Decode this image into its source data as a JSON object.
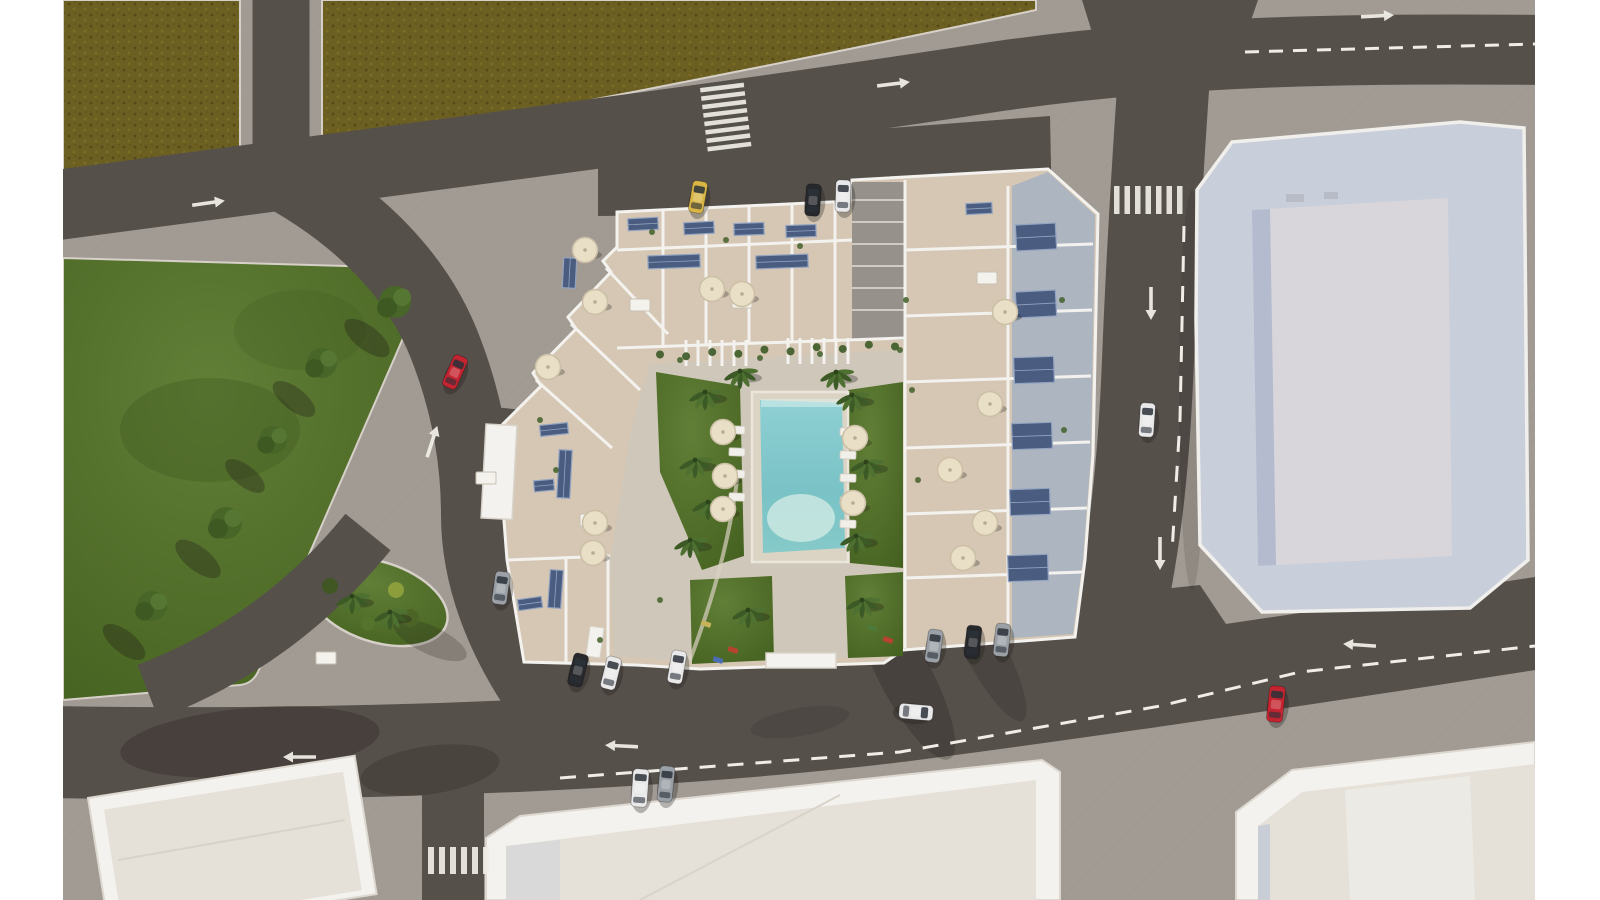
{
  "scene": {
    "title": "Aerial 3D architectural render of a residential apartment complex with rooftop terraces, solar panels and a central courtyard pool",
    "view": "top-down aerial render",
    "environment": "urban block with avenues, crosswalks, lane arrows, parked and moving cars, green park and olive fields"
  },
  "colors": {
    "canvas_bg": "#ffffff",
    "sidewalk": "#a29b94",
    "road": "#56504b",
    "field": "#6c5f22",
    "field_dark": "#554a18",
    "grass": "#587932",
    "grass_dark": "#3e5a20",
    "building_band": "#c9cedb",
    "building_roof": "#d8d6da",
    "building_shade": "#b4bbcf",
    "roof_cream": "#e5e0d8",
    "wall_white": "#f4f2ee",
    "terrace_floor": "#d5c7b4",
    "terrace_floor_blue": "#a9b2c1",
    "courtyard_paving": "#cfc8ba",
    "alley": "#96918b",
    "pool_deep": "#79c2c6",
    "pool_light": "#93d1d4",
    "pool_shallow": "#c6e6e0",
    "solar_panel": "#4a5d80",
    "solar_frame": "#93a3c0",
    "umbrella": "#e9dec6",
    "marking": "#efede6",
    "shadow": "#1f1a16",
    "car_red": "#c42430",
    "car_white": "#e9e9ea",
    "car_black": "#26282c",
    "car_gray": "#9aa0a6",
    "car_yellow": "#d8b545"
  },
  "inventory": {
    "cars": [
      {
        "name": "red-car-park-road",
        "color": "car_red",
        "x": 455,
        "y": 372,
        "rot": 24,
        "l": 34,
        "w": 15
      },
      {
        "name": "white-car-right-road",
        "color": "car_white",
        "x": 1147,
        "y": 420,
        "rot": 4,
        "l": 34,
        "w": 15
      },
      {
        "name": "red-car-bottom-road",
        "color": "car_red",
        "x": 1276,
        "y": 704,
        "rot": 6,
        "l": 36,
        "w": 16
      },
      {
        "name": "white-car-bottom-road",
        "color": "car_white",
        "x": 916,
        "y": 712,
        "rot": 95,
        "l": 34,
        "w": 15
      },
      {
        "name": "white-car-queue-1",
        "color": "car_white",
        "x": 640,
        "y": 788,
        "rot": 4,
        "l": 38,
        "w": 16
      },
      {
        "name": "gray-car-queue-2",
        "color": "car_gray",
        "x": 666,
        "y": 784,
        "rot": 6,
        "l": 36,
        "w": 15
      },
      {
        "name": "yellow-car-top-parking",
        "color": "car_yellow",
        "x": 698,
        "y": 197,
        "rot": 10,
        "l": 32,
        "w": 15
      },
      {
        "name": "black-car-top-parking",
        "color": "car_black",
        "x": 813,
        "y": 200,
        "rot": 4,
        "l": 32,
        "w": 15
      },
      {
        "name": "white-car-top-parking",
        "color": "car_white",
        "x": 843,
        "y": 196,
        "rot": 2,
        "l": 32,
        "w": 15
      },
      {
        "name": "gray-car-left-parking",
        "color": "car_gray",
        "x": 501,
        "y": 588,
        "rot": 8,
        "l": 33,
        "w": 15
      },
      {
        "name": "black-car-bottom-parking-1",
        "color": "car_black",
        "x": 578,
        "y": 670,
        "rot": 14,
        "l": 33,
        "w": 15
      },
      {
        "name": "white-car-bottom-parking-2",
        "color": "car_white",
        "x": 611,
        "y": 673,
        "rot": 14,
        "l": 33,
        "w": 15
      },
      {
        "name": "white-car-bottom-parking-3",
        "color": "car_white",
        "x": 677,
        "y": 667,
        "rot": 10,
        "l": 33,
        "w": 15
      },
      {
        "name": "gray-car-bottom-parking-4",
        "color": "car_gray",
        "x": 934,
        "y": 646,
        "rot": 8,
        "l": 33,
        "w": 15
      },
      {
        "name": "black-car-bottom-parking-5",
        "color": "car_black",
        "x": 973,
        "y": 642,
        "rot": 6,
        "l": 33,
        "w": 15
      },
      {
        "name": "gray-car-bottom-parking-6",
        "color": "car_gray",
        "x": 1002,
        "y": 640,
        "rot": 6,
        "l": 33,
        "w": 15
      }
    ],
    "arrows": [
      {
        "name": "arrow-top-avenue-west",
        "x": 208,
        "y": 203,
        "rot": -8
      },
      {
        "name": "arrow-top-avenue-mid",
        "x": 893,
        "y": 84,
        "rot": -7
      },
      {
        "name": "arrow-top-avenue-east",
        "x": 1377,
        "y": 16,
        "rot": -3
      },
      {
        "name": "arrow-right-road-upper",
        "x": 1151,
        "y": 303,
        "rot": 90
      },
      {
        "name": "arrow-right-road-lower",
        "x": 1160,
        "y": 553,
        "rot": 90
      },
      {
        "name": "arrow-park-road",
        "x": 432,
        "y": 442,
        "rot": -72
      },
      {
        "name": "arrow-bottom-avenue-mid",
        "x": 622,
        "y": 746,
        "rot": 183
      },
      {
        "name": "arrow-bottom-avenue-east",
        "x": 1360,
        "y": 645,
        "rot": 184
      },
      {
        "name": "arrow-bottom-avenue-west",
        "x": 300,
        "y": 757,
        "rot": 180
      }
    ],
    "crosswalks": [
      {
        "name": "crosswalk-top-avenue",
        "x": 700,
        "y": 88,
        "rot": -7,
        "count": 8,
        "stripe_len": 44,
        "stripe_w": 4.5,
        "step": 8.5,
        "orient": "stack"
      },
      {
        "name": "crosswalk-right-road",
        "x": 1114,
        "y": 186,
        "rot": 0,
        "count": 7,
        "stripe_len": 28,
        "stripe_w": 5.5,
        "step": 10.5,
        "orient": "row"
      },
      {
        "name": "crosswalk-side-street",
        "x": 428,
        "y": 847,
        "rot": 0,
        "count": 6,
        "stripe_len": 27,
        "stripe_w": 6,
        "step": 11,
        "orient": "row"
      }
    ],
    "umbrellas": [
      [
        585,
        250
      ],
      [
        712,
        289
      ],
      [
        742,
        294
      ],
      [
        595,
        302
      ],
      [
        548,
        367
      ],
      [
        595,
        523
      ],
      [
        593,
        553
      ],
      [
        723,
        432
      ],
      [
        725,
        476
      ],
      [
        723,
        509
      ],
      [
        855,
        438
      ],
      [
        853,
        503
      ],
      [
        1005,
        312
      ],
      [
        990,
        404
      ],
      [
        950,
        470
      ],
      [
        985,
        523
      ],
      [
        963,
        558
      ]
    ],
    "palm_trees": [
      [
        705,
        392
      ],
      [
        695,
        460
      ],
      [
        708,
        502
      ],
      [
        690,
        540
      ],
      [
        852,
        395
      ],
      [
        866,
        462
      ],
      [
        856,
        536
      ],
      [
        740,
        371
      ],
      [
        836,
        372
      ],
      [
        862,
        600
      ],
      [
        748,
        610
      ],
      [
        352,
        596
      ],
      [
        390,
        612
      ]
    ],
    "park_trees": [
      [
        395,
        302,
        16
      ],
      [
        322,
        363,
        15
      ],
      [
        273,
        440,
        14
      ],
      [
        226,
        523,
        16
      ],
      [
        152,
        606,
        15
      ]
    ],
    "bushes": [
      {
        "x": 410,
        "y": 618,
        "r": 9,
        "c": "#4c6426"
      },
      {
        "x": 330,
        "y": 586,
        "r": 8,
        "c": "#3f5621"
      },
      {
        "x": 368,
        "y": 624,
        "r": 7,
        "c": "#55742c"
      },
      {
        "x": 396,
        "y": 590,
        "r": 8,
        "c": "#8fa03c"
      }
    ],
    "solar_panels": [
      {
        "x": 628,
        "y": 218,
        "w": 30,
        "h": 12,
        "rot": -3
      },
      {
        "x": 684,
        "y": 222,
        "w": 30,
        "h": 12,
        "rot": -3
      },
      {
        "x": 734,
        "y": 223,
        "w": 30,
        "h": 12,
        "rot": -2
      },
      {
        "x": 786,
        "y": 225,
        "w": 30,
        "h": 12,
        "rot": -2
      },
      {
        "x": 648,
        "y": 255,
        "w": 52,
        "h": 13,
        "rot": -2
      },
      {
        "x": 756,
        "y": 255,
        "w": 52,
        "h": 13,
        "rot": -2
      },
      {
        "x": 563,
        "y": 258,
        "w": 13,
        "h": 30,
        "rot": 3
      },
      {
        "x": 540,
        "y": 424,
        "w": 28,
        "h": 11,
        "rot": -6
      },
      {
        "x": 558,
        "y": 450,
        "w": 13,
        "h": 48,
        "rot": 3
      },
      {
        "x": 534,
        "y": 480,
        "w": 20,
        "h": 11,
        "rot": -5
      },
      {
        "x": 549,
        "y": 570,
        "w": 13,
        "h": 38,
        "rot": 4
      },
      {
        "x": 518,
        "y": 598,
        "w": 24,
        "h": 11,
        "rot": -8
      },
      {
        "x": 1016,
        "y": 224,
        "w": 40,
        "h": 26,
        "rot": -3
      },
      {
        "x": 1016,
        "y": 291,
        "w": 40,
        "h": 26,
        "rot": -3
      },
      {
        "x": 1014,
        "y": 357,
        "w": 40,
        "h": 26,
        "rot": -2
      },
      {
        "x": 1012,
        "y": 423,
        "w": 40,
        "h": 26,
        "rot": -2
      },
      {
        "x": 1010,
        "y": 489,
        "w": 40,
        "h": 26,
        "rot": -2
      },
      {
        "x": 1008,
        "y": 555,
        "w": 40,
        "h": 26,
        "rot": -2
      },
      {
        "x": 966,
        "y": 203,
        "w": 26,
        "h": 11,
        "rot": -3
      }
    ],
    "sun_loungers": [
      [
        737,
        430
      ],
      [
        737,
        452
      ],
      [
        737,
        474
      ],
      [
        737,
        497
      ],
      [
        848,
        432
      ],
      [
        848,
        455
      ],
      [
        848,
        478
      ],
      [
        848,
        501
      ],
      [
        848,
        524
      ]
    ],
    "tables": [
      [
        640,
        305
      ],
      [
        742,
        302
      ],
      [
        987,
        278
      ],
      [
        486,
        478
      ],
      [
        590,
        520
      ],
      [
        326,
        658
      ]
    ],
    "plants": [
      [
        652,
        232
      ],
      [
        726,
        240
      ],
      [
        800,
        246
      ],
      [
        906,
        300
      ],
      [
        912,
        390
      ],
      [
        918,
        480
      ],
      [
        1062,
        300
      ],
      [
        1064,
        430
      ],
      [
        540,
        420
      ],
      [
        556,
        470
      ],
      [
        600,
        640
      ],
      [
        660,
        600
      ],
      [
        680,
        360
      ],
      [
        760,
        358
      ],
      [
        820,
        354
      ],
      [
        900,
        350
      ]
    ],
    "playground_items": [
      {
        "x": 718,
        "y": 660,
        "c": "#4a6db5"
      },
      {
        "x": 733,
        "y": 650,
        "c": "#b8432f"
      },
      {
        "x": 706,
        "y": 624,
        "c": "#c7b25a"
      },
      {
        "x": 872,
        "y": 628,
        "c": "#4c7a3a"
      },
      {
        "x": 888,
        "y": 640,
        "c": "#b8432f"
      }
    ],
    "hedges": {
      "from": [
        660,
        356
      ],
      "to": [
        895,
        345
      ],
      "count": 10
    },
    "pool": {
      "shape": "rectangular with rounded shallow end",
      "water": "turquoise",
      "deck": "light paving"
    }
  }
}
